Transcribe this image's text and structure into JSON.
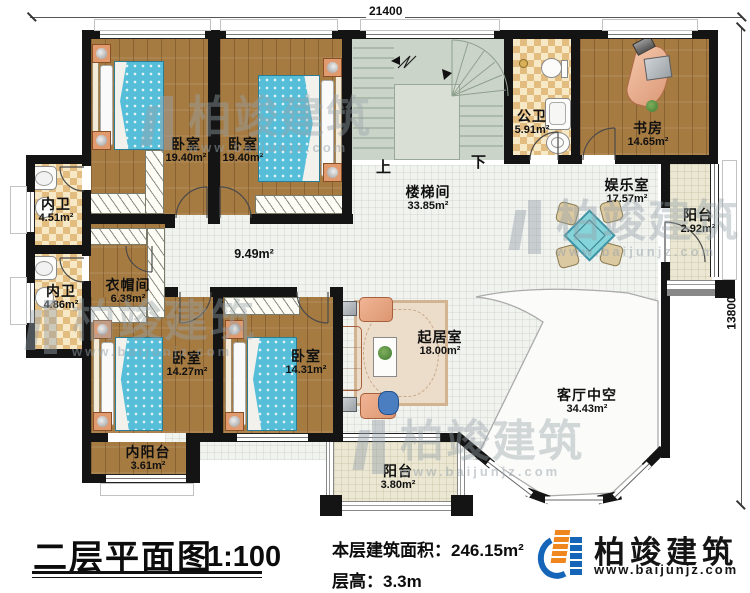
{
  "dimensions": {
    "top": "21400",
    "right": "13800"
  },
  "stairs": {
    "up": "上",
    "down": "下"
  },
  "rooms": [
    {
      "name": "卧室",
      "area": "19.40m²"
    },
    {
      "name": "卧室",
      "area": "19.40m²"
    },
    {
      "name": "内卫",
      "area": "4.51m²"
    },
    {
      "name": "内卫",
      "area": "4.86m²"
    },
    {
      "name": "衣帽间",
      "area": "6.38m²"
    },
    {
      "name": "楼梯间",
      "area": "33.85m²"
    },
    {
      "name": "公卫",
      "area": "5.91m²"
    },
    {
      "name": "书房",
      "area": "14.65m²"
    },
    {
      "name": "娱乐室",
      "area": "17.57m²"
    },
    {
      "name": "阳台",
      "area": "2.92m²"
    },
    {
      "name": "卧室",
      "area": "14.27m²"
    },
    {
      "name": "卧室",
      "area": "14.31m²"
    },
    {
      "name": "内阳台",
      "area": "3.61m²"
    },
    {
      "name": "起居室",
      "area": "18.00m²"
    },
    {
      "name": "客厅中空",
      "area": "34.43m²"
    },
    {
      "name": "阳台",
      "area": "3.80m²"
    }
  ],
  "hallway_area": "9.49m²",
  "title_block": {
    "title": "二层平面图",
    "scale": "1:100",
    "area_label": "本层建筑面积：",
    "area_value": "246.15m²",
    "height_label": "层高：",
    "height_value": "3.3m"
  },
  "branding": {
    "company": "柏竣建筑",
    "website": "www.baijunjz.com"
  },
  "watermark": {
    "text": "柏竣建筑",
    "url": "www.baijunjz.com"
  },
  "colors": {
    "wall": "#141414",
    "wood_floor": "#a67b42",
    "tile": "#f1f3ef",
    "bed": "#57bed9",
    "logo_blue": "#1565b8",
    "logo_orange": "#f0871e"
  }
}
